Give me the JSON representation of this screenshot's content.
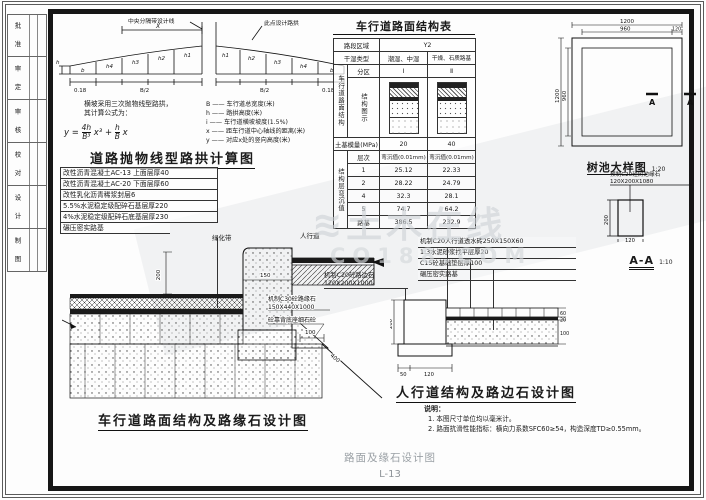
{
  "sheet": {
    "sidebar": [
      "批 准",
      "审 定",
      "审 核",
      "校 对",
      "设 计",
      "制 图"
    ],
    "watermark_logo": "≋",
    "watermark_brand": "土木在线",
    "watermark_url": "CO188.COM",
    "footer_caption": "路面及缘石设计图",
    "sheet_no": "L-13"
  },
  "crown": {
    "title": "道路抛物线型路拱计算图",
    "leader_left": "中央分隔带设计线",
    "leader_right": "此点设计路拱",
    "dim_x": "X",
    "dim_h": "h",
    "dim_half_l": "B/2",
    "dim_half_r": "B/2",
    "edge_l": "0.18",
    "edge_r": "0.18",
    "seg_left": [
      "b",
      "h4",
      "h3",
      "h2",
      "h1"
    ],
    "seg_right": [
      "h1",
      "h2",
      "h3",
      "h4",
      "b"
    ],
    "note1": "横坡采用三次抛物线型路拱，",
    "note2": "其计算公式为：",
    "formula": {
      "lhs": "y =",
      "n1": "4h",
      "d1": "B³",
      "m1": "x³",
      "op": "+",
      "n2": "h",
      "d2": "B",
      "m2": "x"
    },
    "legend": [
      "B —— 车行道总宽度(米)",
      "h —— 路拱高度(米)",
      "i —— 车行道横坡坡度(1.5%)",
      "x —— 距车行道中心轴线的距离(米)",
      "y —— 对应x处的竖向高度(米)"
    ]
  },
  "layers": [
    "改性沥青混凝土AC-13 上面层厚40",
    "改性沥青混凝土AC-20 下面层厚60",
    "改性乳化沥青稀浆封层6",
    "5.5%水泥稳定级配碎石基层厚220",
    "4%水泥稳定级配碎石底基层厚230",
    "碾压密实路基"
  ],
  "table": {
    "title": "车行道路面结构表",
    "region_label": "路段区域",
    "region_value": "Y2",
    "type_label": "干湿类型",
    "type_a": "潮湿、中湿",
    "type_b": "干燥、石质路基",
    "vert_main": "车行道路面结构",
    "zone_label": "分区",
    "zone_a": "Ⅰ",
    "zone_b": "Ⅱ",
    "diagram_label": "结构图示",
    "modulus_label": "土基模量(MPa)",
    "modulus_a": "20",
    "modulus_b": "40",
    "vert_defl": "结构层弯沉值",
    "defl_corner": "层次",
    "defl_col": "弯沉值(0.01mm)",
    "rows": [
      [
        "1",
        "25.12",
        "22.33"
      ],
      [
        "2",
        "28.22",
        "24.79"
      ],
      [
        "4",
        "32.3",
        "28.1"
      ],
      [
        "5",
        "74.7",
        "64.2"
      ],
      [
        "路基",
        "386.5",
        "232.9"
      ]
    ]
  },
  "tree": {
    "title": "树池大样图",
    "scale": "1:20",
    "d_outer": "1200",
    "d_inner": "960",
    "d_border": "120",
    "d_outer_v": "1200",
    "d_inner_v": "960",
    "mark": "A"
  },
  "aa": {
    "callout1": "预制C20砼树池缘石",
    "callout2": "120X200X1080",
    "d_w": "120",
    "d_h": "200",
    "title": "A-A",
    "scale": "1:10"
  },
  "road": {
    "title": "车行道路面结构及路缘石设计图",
    "label_green": "绿化带",
    "label_walk": "人行道",
    "callout1": "机制C30砼路缘石",
    "callout1b": "150X440X1000",
    "callout2": "砼靠背底座细石砼",
    "d150": "150",
    "d200": "200",
    "d100": "100",
    "d400": "400"
  },
  "walk": {
    "title": "人行道结构及路边石设计图",
    "left1": "机制C20砼路边石",
    "left2": "120X200X1000",
    "right": [
      "机制C20人行道透水砖250X150X60",
      "1:3水泥砂浆找平层厚20",
      "C15砼基础垫层厚100",
      "碾压密实路基"
    ],
    "d200": "200",
    "d50": "50",
    "d120": "120",
    "d60": "60",
    "d20": "20",
    "d100": "100"
  },
  "notes": {
    "heading": "说明：",
    "items": [
      "1. 本图尺寸单位均以毫米计。",
      "2. 路面抗滑性能指标：横向力系数SFC60≥54，构造深度TD≥0.55mm。"
    ]
  }
}
